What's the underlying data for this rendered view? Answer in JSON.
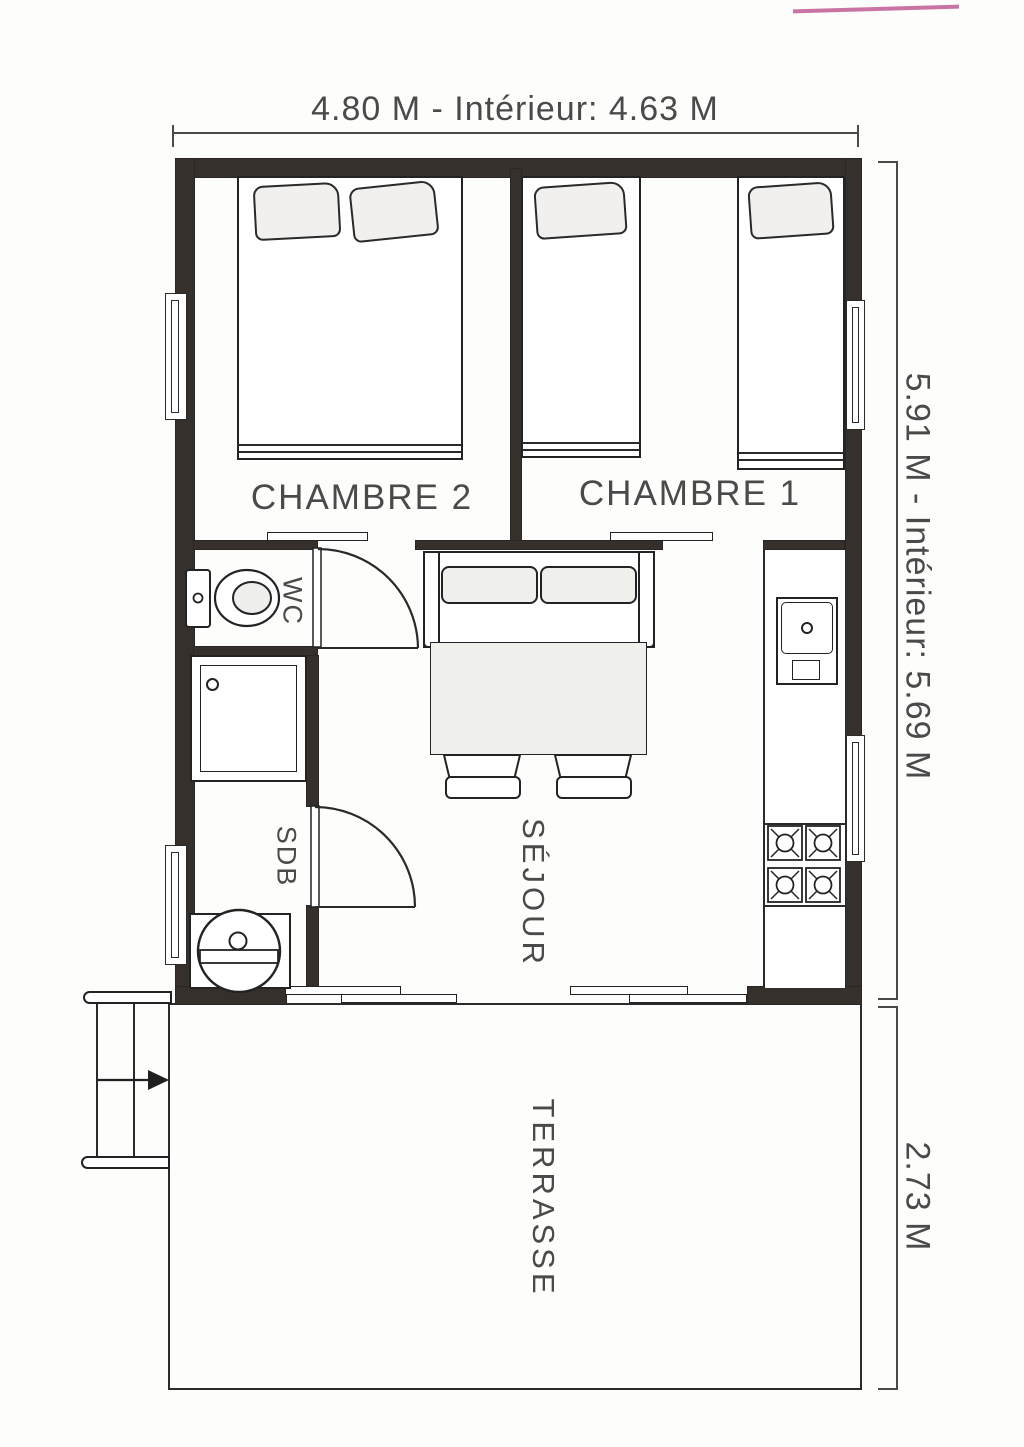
{
  "plan_title": "Chalet floor plan",
  "dimensions": {
    "top": "4.80 M - Intérieur: 4.63 M",
    "side_main": "5.91 M - Intérieur: 5.69 M",
    "side_terrace": "2.73 M"
  },
  "rooms": {
    "bedroom2": {
      "label": "CHAMBRE 2"
    },
    "bedroom1": {
      "label": "CHAMBRE 1"
    },
    "wc": {
      "label": "WC"
    },
    "bathroom": {
      "label": "SDB"
    },
    "living_room": {
      "label": "SÉJOUR"
    },
    "terrace": {
      "label": "TERRASSE"
    }
  },
  "symbols": [
    "double-bed",
    "single-bed",
    "single-bed",
    "pillow",
    "sofa",
    "table",
    "chair",
    "chair",
    "kitchen-sink",
    "stove-4-burners",
    "toilet",
    "shower",
    "washbasin",
    "hinged-door",
    "hinged-door",
    "sliding-door",
    "sliding-door",
    "sliding-bay-door",
    "sliding-bay-door",
    "window",
    "window",
    "window",
    "window",
    "stairs",
    "direction-arrow"
  ],
  "colors": {
    "wall": "#35302c",
    "line": "#232323",
    "text": "#4a4a4a",
    "light_fill": "#efefec",
    "background": "#fdfdfc",
    "scan_artifact_pink": "#bf5c92"
  }
}
